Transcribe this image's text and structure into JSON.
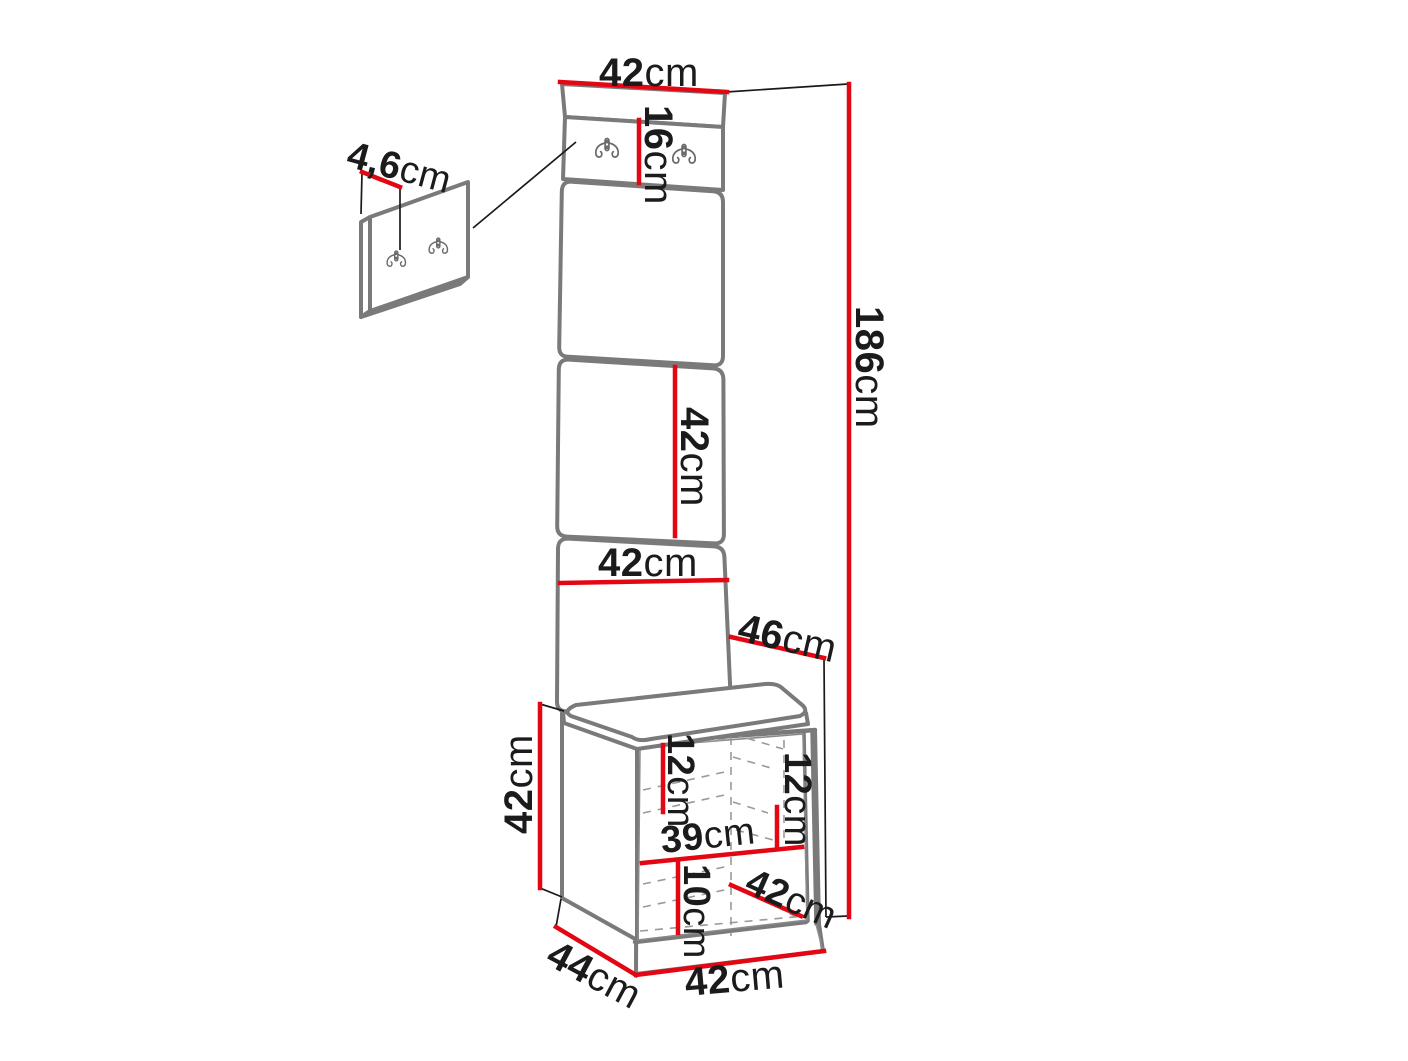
{
  "diagram": {
    "type": "furniture-dimension-diagram",
    "subject": "hallway set: wall hook panel, upholstered panel column and seat cabinet with open interior",
    "unit": "cm",
    "colors": {
      "dimension_line": "#e30613",
      "outline_gray": "#7a7a7a",
      "thin_line": "#1a1a1a",
      "background": "#ffffff"
    },
    "icons": {
      "hook": "double-hook-icon"
    },
    "dimensions": {
      "top_width": {
        "value": "42",
        "unit": "cm",
        "label": "42cm"
      },
      "hook_panel_height": {
        "value": "16",
        "unit": "cm",
        "label": "16cm"
      },
      "wall_panel_thickness": {
        "value": "4,6",
        "unit": "cm",
        "label": "4,6cm"
      },
      "total_height": {
        "value": "186",
        "unit": "cm",
        "label": "186cm"
      },
      "middle_panel_height": {
        "value": "42",
        "unit": "cm",
        "label": "42cm"
      },
      "lower_panel_width": {
        "value": "42",
        "unit": "cm",
        "label": "42cm"
      },
      "seat_depth": {
        "value": "46",
        "unit": "cm",
        "label": "46cm"
      },
      "cabinet_height": {
        "value": "42",
        "unit": "cm",
        "label": "42cm"
      },
      "left_shelf_gap": {
        "value": "12",
        "unit": "cm",
        "label": "12cm"
      },
      "right_shelf_gap": {
        "value": "12",
        "unit": "cm",
        "label": "12cm"
      },
      "interior_width": {
        "value": "39",
        "unit": "cm",
        "label": "39cm"
      },
      "bottom_gap": {
        "value": "10",
        "unit": "cm",
        "label": "10cm"
      },
      "door_width": {
        "value": "42",
        "unit": "cm",
        "label": "42cm"
      },
      "cabinet_depth": {
        "value": "44",
        "unit": "cm",
        "label": "44cm"
      },
      "cabinet_width": {
        "value": "42",
        "unit": "cm",
        "label": "42cm"
      }
    }
  }
}
